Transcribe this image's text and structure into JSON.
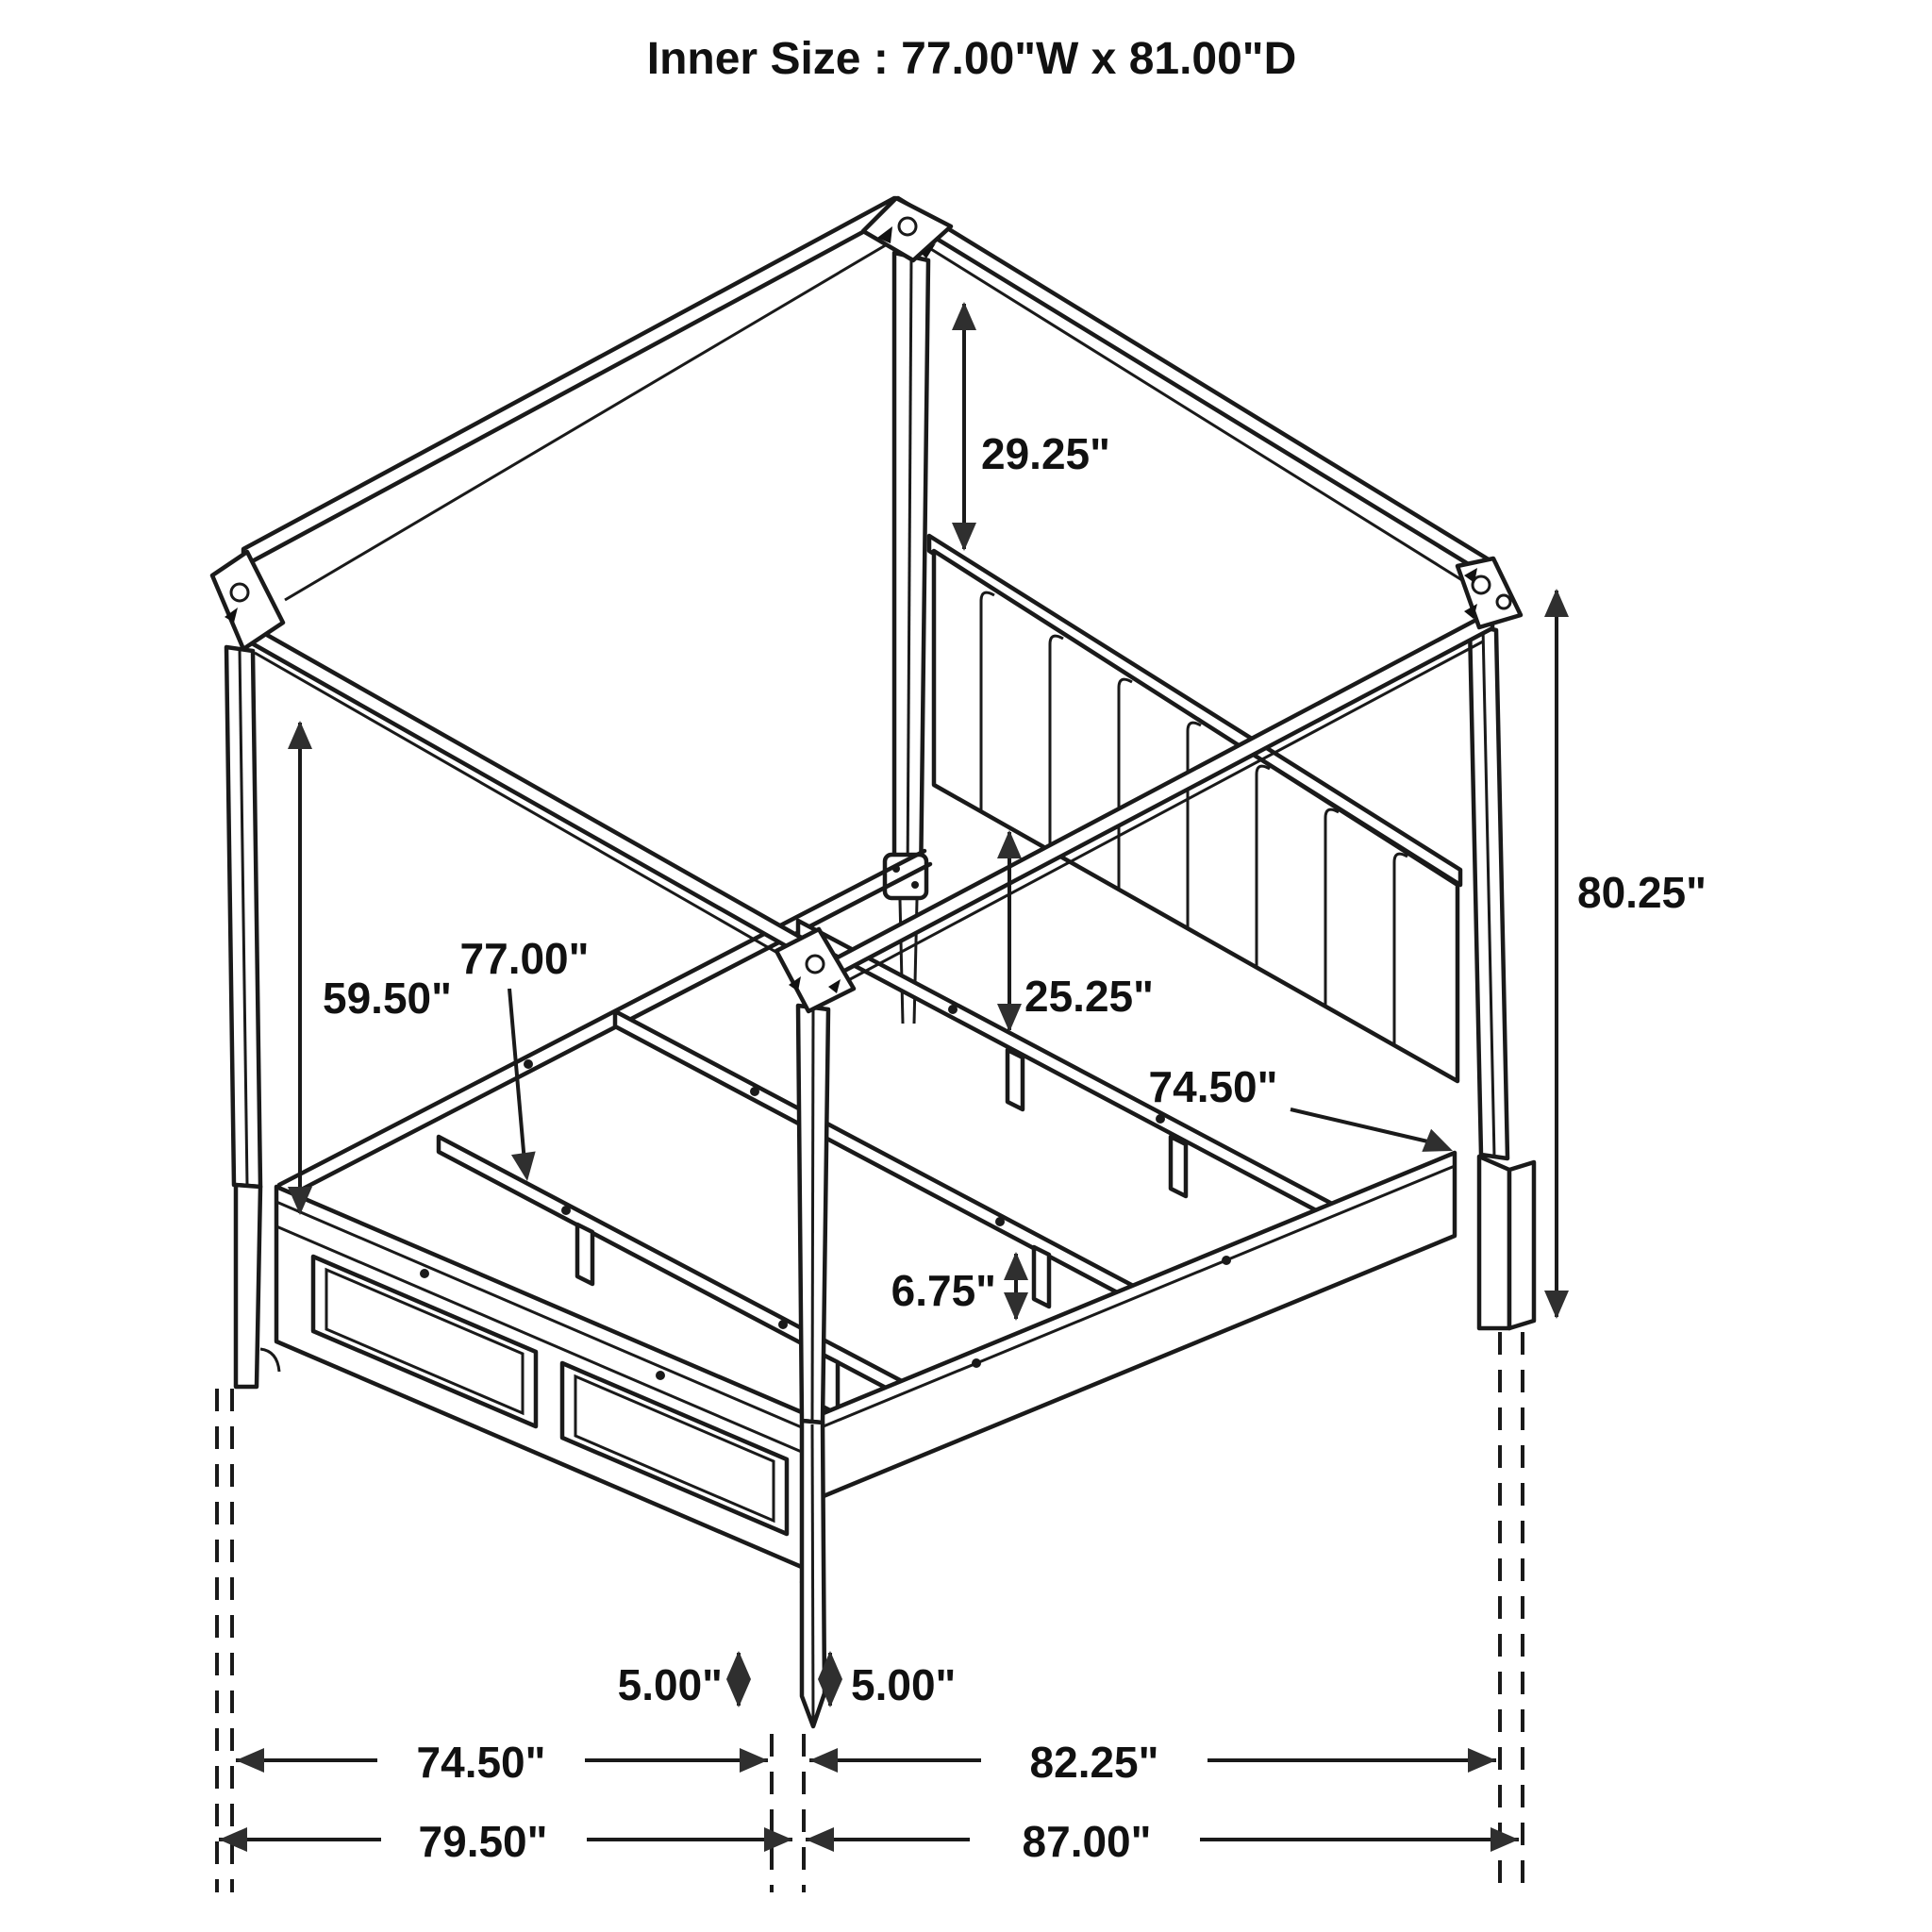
{
  "title": "Inner Size : 77.00\"W x 81.00\"D",
  "diagram": {
    "type": "furniture-dimension-diagram",
    "subject": "four-poster canopy storage bed, isometric black-and-white line drawing",
    "units": "inches",
    "inner_size": {
      "width": "77.00\"W",
      "depth": "81.00\"D"
    },
    "colors": {
      "line": "#1a1a1a",
      "background": "#ffffff",
      "arrow_fill": "#2f2f2f",
      "text": "#111111"
    },
    "dimensions": {
      "canopy_to_headboard_drop": "29.25\"",
      "overall_post_height": "80.25\"",
      "canopy_underside_to_rail": "59.50\"",
      "slat_length": "77.00\"",
      "headboard_bottom_to_slat": "25.25\"",
      "side_rail_length": "74.50\"",
      "slat_leg_height": "6.75\"",
      "front_leg_height": "5.00\"",
      "side_leg_height": "5.00\"",
      "floor_span_footboard_inner": "74.50\"",
      "floor_span_siderail_inner": "82.25\"",
      "floor_overall_width": "79.50\"",
      "floor_overall_depth": "87.00\""
    }
  }
}
